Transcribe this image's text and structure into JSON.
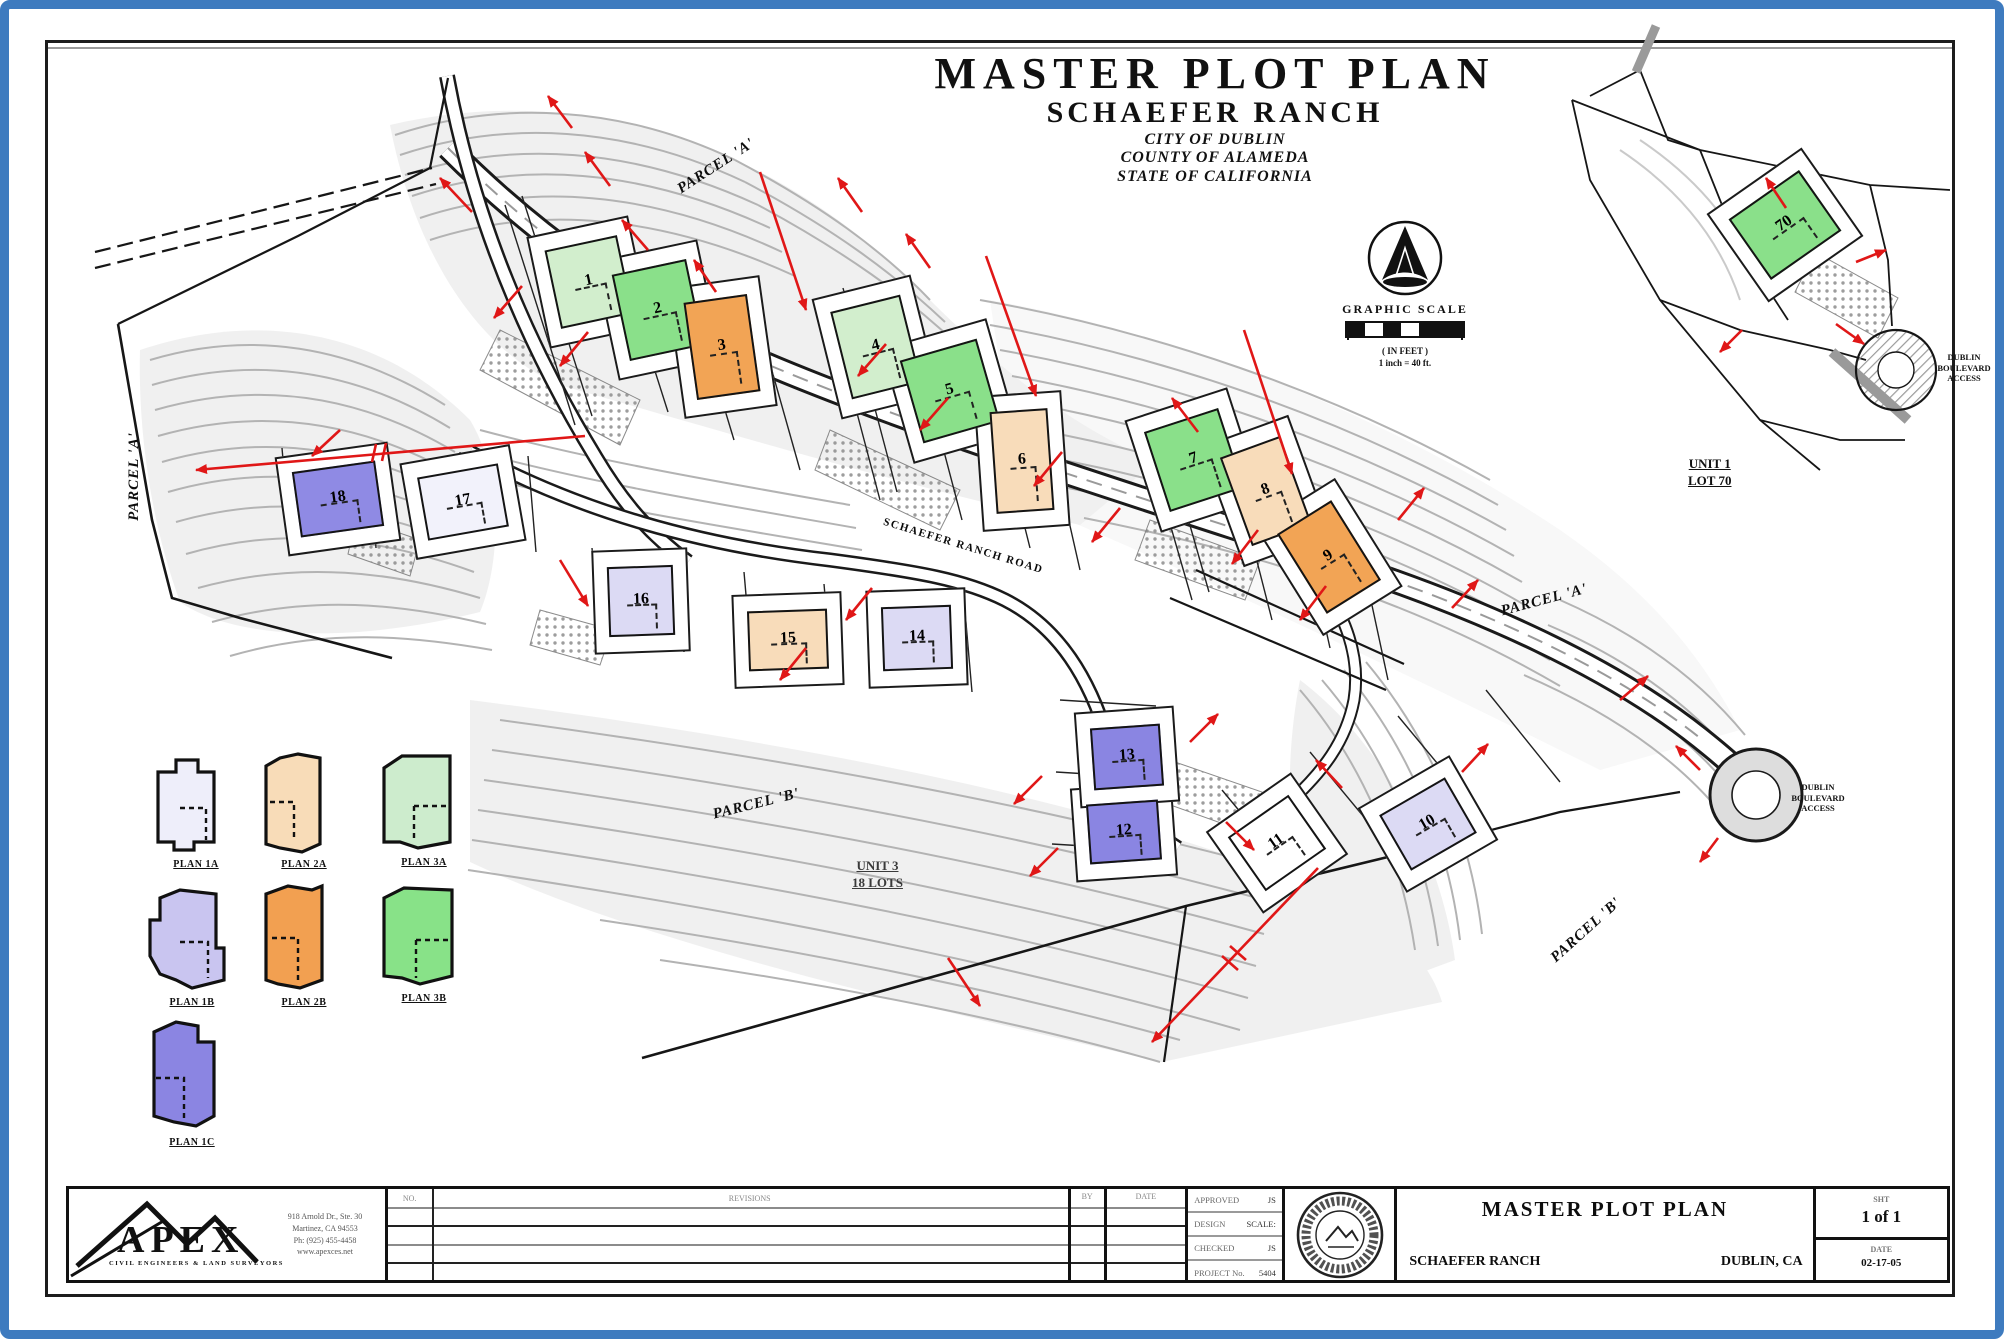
{
  "header": {
    "title": "MASTER PLOT PLAN",
    "subtitle": "SCHAEFER RANCH",
    "city": "CITY OF DUBLIN",
    "county": "COUNTY OF ALAMEDA",
    "state": "STATE OF CALIFORNIA"
  },
  "compass_scale": {
    "graphic_scale": "GRAPHIC SCALE",
    "in_feet": "( IN FEET )",
    "scale_note": "1 inch = 40 ft."
  },
  "plan": {
    "road_label": "SCHAEFER RANCH ROAD",
    "parcel_label_top": "PARCEL 'A'",
    "parcel_label_right": "PARCEL 'A'",
    "parcel_label_bottom_left": "PARCEL 'B'",
    "parcel_label_bottom_right": "PARCEL 'B'",
    "parcel_label_west": "PARCEL 'A'",
    "unit_note": {
      "line1": "UNIT 3",
      "line2": "18 LOTS"
    },
    "culdesac_label": {
      "line1": "DUBLIN",
      "line2": "BOULEVARD",
      "line3": "ACCESS"
    },
    "lots": [
      {
        "num": "1",
        "color": "#d2eecd"
      },
      {
        "num": "2",
        "color": "#8ae08a"
      },
      {
        "num": "3",
        "color": "#f2a455"
      },
      {
        "num": "4",
        "color": "#d2eecd"
      },
      {
        "num": "5",
        "color": "#8ae08a"
      },
      {
        "num": "6",
        "color": "#f8dcba"
      },
      {
        "num": "7",
        "color": "#8ae08a"
      },
      {
        "num": "8",
        "color": "#f8dcba"
      },
      {
        "num": "9",
        "color": "#f2a455"
      },
      {
        "num": "10",
        "color": "#dcdaf4"
      },
      {
        "num": "11",
        "color": "#ffffff"
      },
      {
        "num": "12",
        "color": "#8a85e2"
      },
      {
        "num": "13",
        "color": "#8a85e2"
      },
      {
        "num": "14",
        "color": "#dcdaf4"
      },
      {
        "num": "15",
        "color": "#f8dcba"
      },
      {
        "num": "16",
        "color": "#dcdaf4"
      },
      {
        "num": "17",
        "color": "#f2f2fb"
      },
      {
        "num": "18",
        "color": "#8f8ae4"
      }
    ]
  },
  "inset": {
    "lot": {
      "num": "70",
      "color": "#8ae08a"
    },
    "unit_line1": "UNIT 1",
    "unit_line2": "LOT 70",
    "label": {
      "line1": "DUBLIN",
      "line2": "BOULEVARD",
      "line3": "ACCESS"
    }
  },
  "legend": {
    "items": [
      {
        "label": "PLAN 1A",
        "color": "#eeeefa"
      },
      {
        "label": "PLAN 2A",
        "color": "#f8dcb8"
      },
      {
        "label": "PLAN 3A",
        "color": "#cdeccd"
      },
      {
        "label": "PLAN 1B",
        "color": "#c9c5f0"
      },
      {
        "label": "PLAN 2B",
        "color": "#f2a051"
      },
      {
        "label": "PLAN 3B",
        "color": "#88e288"
      },
      {
        "label": "PLAN 1C",
        "color": "#8b85e2"
      }
    ]
  },
  "titleblock": {
    "apex": {
      "name": "APEX",
      "tagline": "CIVIL ENGINEERS & LAND SURVEYORS",
      "addr1": "918 Arnold Dr., Ste. 30",
      "addr2": "Martinez, CA 94553",
      "addr3": "Ph: (925) 455-4458",
      "addr4": "www.apexces.net"
    },
    "revisions": {
      "no_header": "NO.",
      "revisions_header": "REVISIONS",
      "by_header": "BY",
      "date_header": "DATE"
    },
    "approvals": {
      "rows": [
        {
          "label": "APPROVED",
          "value": "JS"
        },
        {
          "label": "DESIGN",
          "value": "SCALE:"
        },
        {
          "label": "CHECKED",
          "value": "JS"
        },
        {
          "label": "PROJECT No.",
          "value": "5404"
        }
      ]
    },
    "title": {
      "main": "MASTER PLOT PLAN",
      "project": "SCHAEFER RANCH",
      "location": "DUBLIN, CA"
    },
    "sheet": {
      "sht_label": "SHT",
      "sht_value": "1 of 1",
      "date_label": "DATE",
      "date_value": "02-17-05"
    }
  }
}
